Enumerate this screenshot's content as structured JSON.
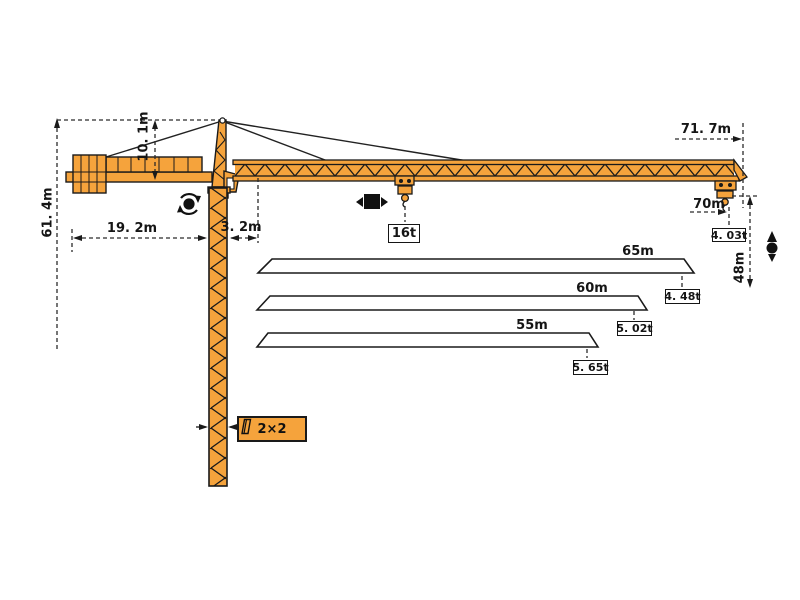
{
  "diagram": {
    "title": "tower-crane-dimension-and-load-diagram",
    "colors": {
      "crane_fill": "#F5A33C",
      "outline": "#1A1A1A",
      "dash_line": "#2B2B2B",
      "background": "#FFFFFF"
    },
    "dimensions": {
      "total_height": "61. 4m",
      "tower_head_height": "10. 1m",
      "counter_jib_length": "19. 2m",
      "rear_offset": "3. 2m",
      "overall_radius": "71. 7m",
      "tip_radius": "70m",
      "hook_travel": "48m",
      "mast_section": "2×2"
    },
    "loads": {
      "max_load": "16t",
      "tip_load_at_70m": "4. 03t"
    },
    "jib_options": [
      {
        "length": "65m",
        "tip_load": "4. 48t"
      },
      {
        "length": "60m",
        "tip_load": "5. 02t"
      },
      {
        "length": "55m",
        "tip_load": "5. 65t"
      }
    ],
    "icons": {
      "slewing": "slewing-rotation-icon",
      "trolley": "trolley-travel-icon",
      "hoist": "hoisting-icon",
      "mast_section": "mast-section-icon"
    }
  }
}
